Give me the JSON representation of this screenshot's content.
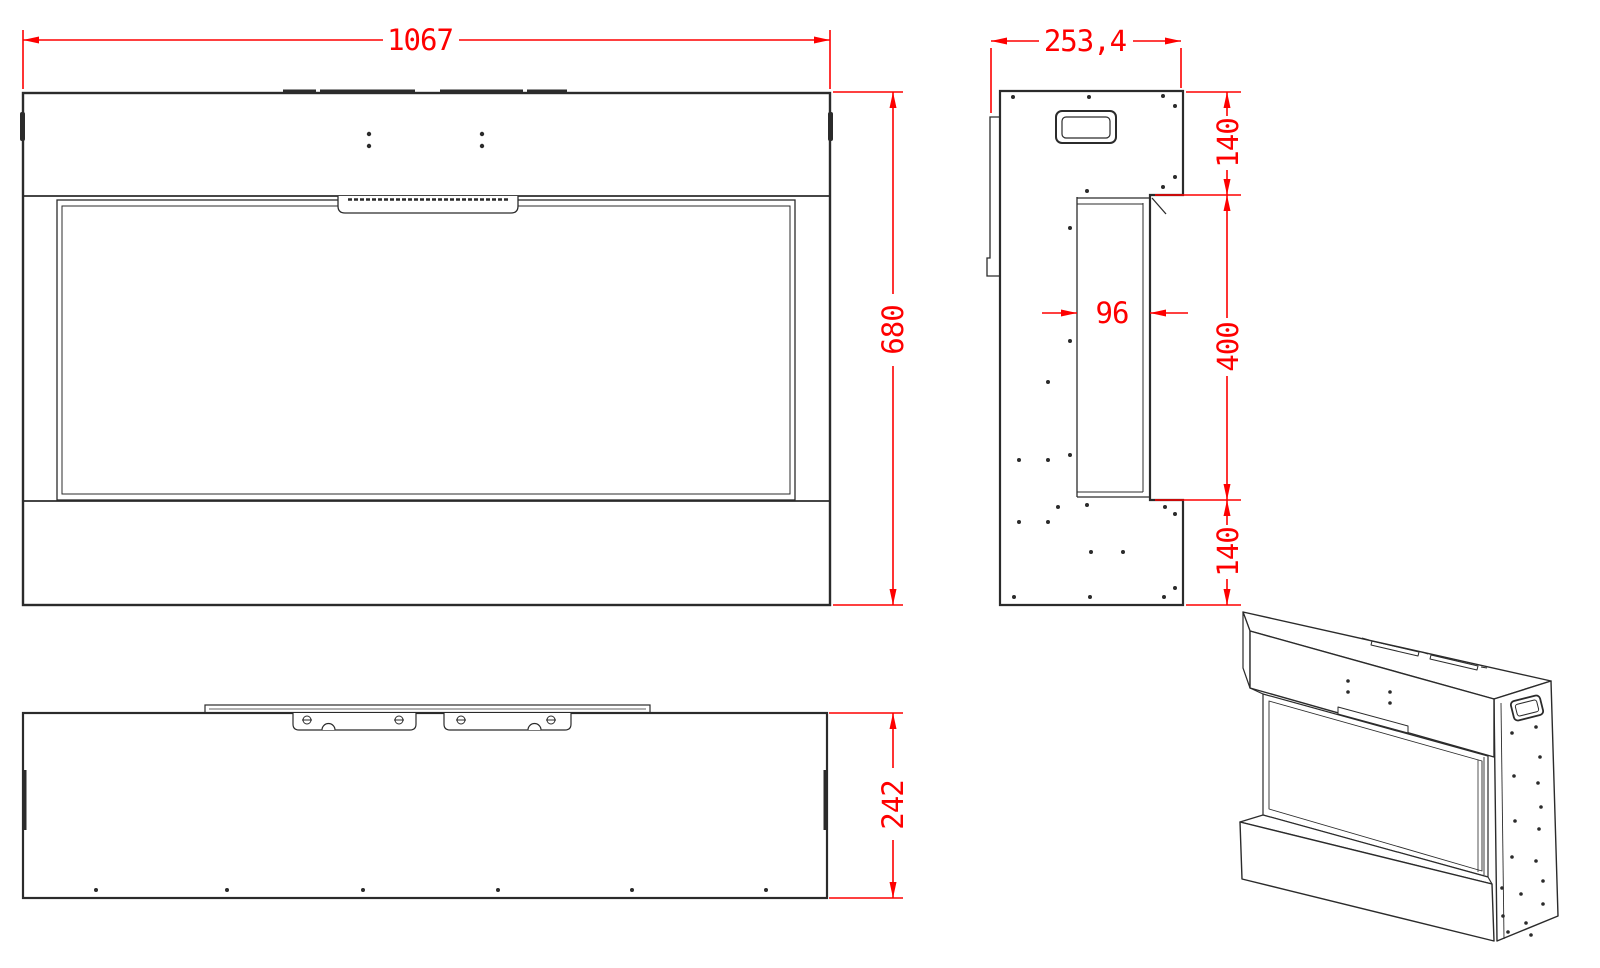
{
  "drawing": {
    "background_color": "#ffffff",
    "line_color": "#2b2b2b",
    "dimension_color": "#fe0000",
    "dimensions": {
      "front_width": "1067",
      "front_height": "680",
      "side_depth": "253,4",
      "side_top_section": "140",
      "side_glass_section": "400",
      "side_bottom_section": "140",
      "glass_channel_width": "96",
      "plan_depth": "242"
    }
  }
}
